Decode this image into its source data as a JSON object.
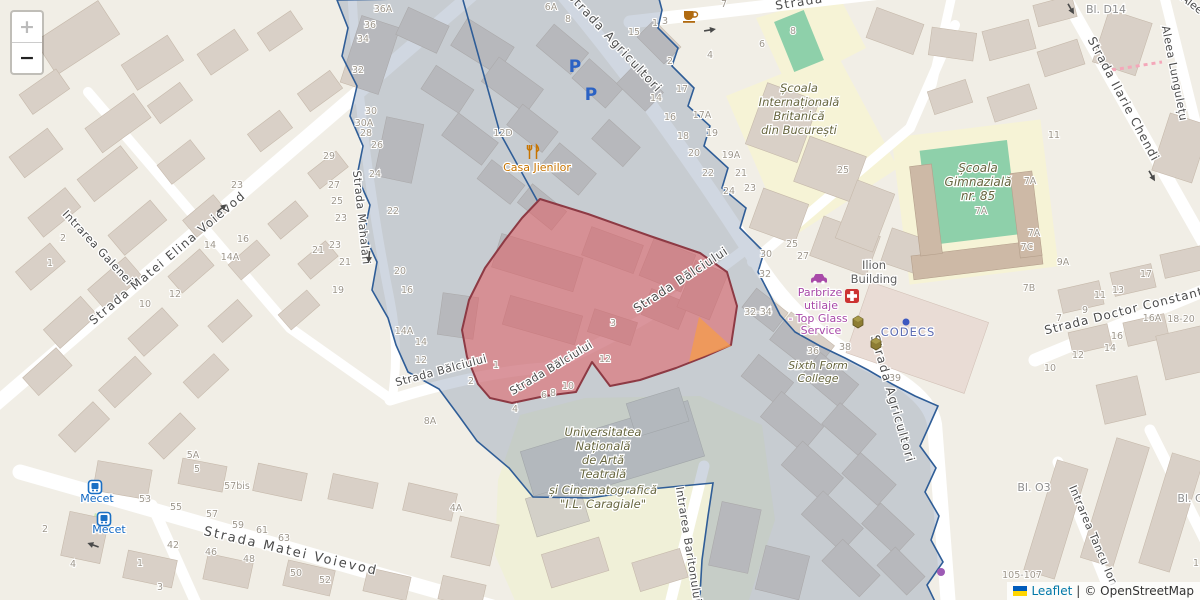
{
  "controls": {
    "zoom_in": "+",
    "zoom_out": "−"
  },
  "attribution": {
    "leaflet": "Leaflet",
    "separator": "|",
    "copyright": "© OpenStreetMap"
  },
  "colors": {
    "boundary_blue": "#2f5d97",
    "district_fill": "rgba(120,140,170,0.35)",
    "selection_red_stroke": "#8d3a44",
    "selection_red_fill": "rgba(225,95,100,0.55)",
    "highlight_orange": "rgba(244,155,78,0.8)",
    "road_white": "#ffffff",
    "building_fill": "#d9d0c7",
    "school_area": "#f6f3d6",
    "university_area": "#f0f0d8",
    "pitch_green": "#8ed0aa",
    "crossing_pink": "#f4a7b9"
  },
  "street_labels": [
    {
      "t": "Strada Agricultori",
      "x": 612,
      "y": 45,
      "rot": 47,
      "size": 12,
      "ls": 1.5
    },
    {
      "t": "Strada Agricultori",
      "x": 889,
      "y": 400,
      "rot": 74,
      "size": 12,
      "ls": 1.5
    },
    {
      "t": "Strada Bălciului",
      "x": 683,
      "y": 283,
      "rot": -33,
      "size": 12,
      "ls": 1
    },
    {
      "t": "Strada Bălciului",
      "x": 553,
      "y": 371,
      "rot": -31,
      "size": 11,
      "ls": 0.5
    },
    {
      "t": "Strada Bălciului",
      "x": 442,
      "y": 374,
      "rot": -15,
      "size": 11,
      "ls": 0.5
    },
    {
      "t": "Strada Matei Voievod",
      "x": 290,
      "y": 555,
      "rot": 13,
      "size": 13,
      "ls": 2
    },
    {
      "t": "Strada Matei Elina Voievod",
      "x": 170,
      "y": 261,
      "rot": -40,
      "size": 12,
      "ls": 1.5
    },
    {
      "t": "Intrarea Galenei",
      "x": 95,
      "y": 250,
      "rot": 47,
      "size": 11,
      "ls": 0.5
    },
    {
      "t": "Strada Mahalari",
      "x": 358,
      "y": 218,
      "rot": 84,
      "size": 11,
      "ls": 0.5
    },
    {
      "t": "Strada Ilarie Chendi",
      "x": 1120,
      "y": 101,
      "rot": 62,
      "size": 12,
      "ls": 1
    },
    {
      "t": "Aleea Lungulețu",
      "x": 1171,
      "y": 74,
      "rot": 79,
      "size": 11,
      "ls": 0.5
    },
    {
      "t": "Alee",
      "x": 1190,
      "y": 7,
      "rot": 38,
      "size": 11,
      "ls": 0
    },
    {
      "t": "Strada Doctor Constantin Zl",
      "x": 1140,
      "y": 311,
      "rot": -14,
      "size": 12,
      "ls": 1
    },
    {
      "t": "Intrarea Tancu Ion",
      "x": 1090,
      "y": 537,
      "rot": 67,
      "size": 11,
      "ls": 0.5
    },
    {
      "t": "Intrarea Baritonului",
      "x": 685,
      "y": 545,
      "rot": 81,
      "size": 11,
      "ls": 0.5
    },
    {
      "t": "Strada",
      "x": 800,
      "y": 6,
      "rot": -9,
      "size": 12,
      "ls": 1.5
    }
  ],
  "poi_labels": [
    {
      "t": "Școala",
      "x": 799,
      "y": 92,
      "cls": "school",
      "size": 11.5
    },
    {
      "t": "Internațională",
      "x": 799,
      "y": 106,
      "cls": "school",
      "size": 11.5
    },
    {
      "t": "Britanică",
      "x": 799,
      "y": 120,
      "cls": "school",
      "size": 11.5
    },
    {
      "t": "din București",
      "x": 799,
      "y": 134,
      "cls": "school",
      "size": 11.5
    },
    {
      "t": "Școala",
      "x": 978,
      "y": 172,
      "cls": "school",
      "size": 12
    },
    {
      "t": "Gimnazială",
      "x": 978,
      "y": 186,
      "cls": "school",
      "size": 12
    },
    {
      "t": "nr. 85",
      "x": 978,
      "y": 200,
      "cls": "school",
      "size": 12
    },
    {
      "t": "Sixth Form",
      "x": 818,
      "y": 369,
      "cls": "school",
      "size": 11
    },
    {
      "t": "College",
      "x": 818,
      "y": 382,
      "cls": "school",
      "size": 11
    },
    {
      "t": "Universitatea",
      "x": 603,
      "y": 436,
      "cls": "school",
      "size": 11.5
    },
    {
      "t": "Națională",
      "x": 603,
      "y": 450,
      "cls": "school",
      "size": 11.5
    },
    {
      "t": "de Artă",
      "x": 603,
      "y": 464,
      "cls": "school",
      "size": 11.5
    },
    {
      "t": "Teatrală",
      "x": 603,
      "y": 478,
      "cls": "school",
      "size": 11.5
    },
    {
      "t": "și Cinematografică",
      "x": 603,
      "y": 494,
      "cls": "school",
      "size": 11.5
    },
    {
      "t": "\"I.L. Caragiale\"",
      "x": 603,
      "y": 508,
      "cls": "school",
      "size": 11.5
    },
    {
      "t": "Casa Jienilor",
      "x": 537,
      "y": 171,
      "cls": "restaurant",
      "size": 11
    },
    {
      "t": "Ilion",
      "x": 874,
      "y": 269,
      "cls": "building-label",
      "size": 11.5
    },
    {
      "t": "Building",
      "x": 874,
      "y": 283,
      "cls": "building-label",
      "size": 11.5
    },
    {
      "t": "Parbrize",
      "x": 820,
      "y": 296,
      "cls": "shop",
      "size": 11
    },
    {
      "t": "utilaje",
      "x": 821,
      "y": 309,
      "cls": "shop",
      "size": 11
    },
    {
      "t": "- Top Glass",
      "x": 818,
      "y": 322,
      "cls": "shop",
      "size": 11
    },
    {
      "t": "Service",
      "x": 821,
      "y": 334,
      "cls": "shop",
      "size": 11
    },
    {
      "t": "CODECS",
      "x": 908,
      "y": 336,
      "cls": "office",
      "size": 11.5
    },
    {
      "t": "Mecet",
      "x": 97,
      "y": 502,
      "cls": "transit",
      "size": 11
    },
    {
      "t": "Mecet",
      "x": 109,
      "y": 533,
      "cls": "transit",
      "size": 11
    },
    {
      "t": "Bl. D14",
      "x": 1106,
      "y": 13,
      "cls": "graylabel",
      "size": 11
    },
    {
      "t": "Bl. O3",
      "x": 1034,
      "y": 491,
      "cls": "graylabel",
      "size": 11
    },
    {
      "t": "Bl. C",
      "x": 1190,
      "y": 502,
      "cls": "graylabel",
      "size": 11
    }
  ],
  "house_numbers": [
    [
      "6A",
      551,
      10
    ],
    [
      "8",
      568,
      22
    ],
    [
      "15",
      634,
      35
    ],
    [
      "1",
      655,
      26
    ],
    [
      "3",
      665,
      24
    ],
    [
      "7",
      724,
      7
    ],
    [
      "2",
      670,
      64
    ],
    [
      "4",
      710,
      58
    ],
    [
      "6",
      762,
      47
    ],
    [
      "8",
      793,
      34
    ],
    [
      "17",
      682,
      92
    ],
    [
      "14",
      656,
      101
    ],
    [
      "16",
      670,
      120
    ],
    [
      "18",
      683,
      139
    ],
    [
      "20",
      694,
      156
    ],
    [
      "17A",
      702,
      118
    ],
    [
      "19",
      712,
      136
    ],
    [
      "19A",
      731,
      158
    ],
    [
      "21",
      741,
      176
    ],
    [
      "22",
      708,
      176
    ],
    [
      "23",
      750,
      191
    ],
    [
      "24",
      729,
      194
    ],
    [
      "25",
      843,
      173
    ],
    [
      "11",
      1054,
      138
    ],
    [
      "7A",
      1030,
      184
    ],
    [
      "7A",
      981,
      214
    ],
    [
      "7A",
      1034,
      236
    ],
    [
      "7C",
      1027,
      250
    ],
    [
      "9A",
      1063,
      265
    ],
    [
      "7B",
      1029,
      291
    ],
    [
      "27",
      803,
      259
    ],
    [
      "34",
      766,
      314
    ],
    [
      "36",
      813,
      354
    ],
    [
      "38",
      845,
      350
    ],
    [
      "39",
      895,
      381
    ],
    [
      "25",
      792,
      247
    ],
    [
      "30",
      766,
      257
    ],
    [
      "32",
      765,
      277
    ],
    [
      "32-34",
      758,
      315
    ],
    [
      "14A",
      404,
      334
    ],
    [
      "14",
      421,
      345
    ],
    [
      "12",
      421,
      363
    ],
    [
      "2",
      471,
      384
    ],
    [
      "1",
      496,
      368
    ],
    [
      "4",
      515,
      412
    ],
    [
      "6",
      544,
      398
    ],
    [
      "8",
      553,
      396
    ],
    [
      "10",
      568,
      389
    ],
    [
      "12",
      605,
      362
    ],
    [
      "8A",
      430,
      424
    ],
    [
      "3",
      613,
      326
    ],
    [
      "12D",
      503,
      136
    ],
    [
      "53",
      145,
      502
    ],
    [
      "55",
      176,
      510
    ],
    [
      "57",
      212,
      517
    ],
    [
      "57bis",
      237,
      489
    ],
    [
      "59",
      238,
      528
    ],
    [
      "61",
      262,
      533
    ],
    [
      "63",
      284,
      541
    ],
    [
      "42",
      173,
      548
    ],
    [
      "46",
      211,
      555
    ],
    [
      "48",
      249,
      562
    ],
    [
      "50",
      296,
      576
    ],
    [
      "52",
      325,
      583
    ],
    [
      "4",
      73,
      567
    ],
    [
      "2",
      45,
      532
    ],
    [
      "1",
      140,
      566
    ],
    [
      "3",
      160,
      590
    ],
    [
      "23",
      237,
      188
    ],
    [
      "16",
      243,
      242
    ],
    [
      "14",
      210,
      248
    ],
    [
      "14A",
      230,
      260
    ],
    [
      "12",
      175,
      297
    ],
    [
      "10",
      145,
      307
    ],
    [
      "2",
      63,
      241
    ],
    [
      "1",
      50,
      266
    ],
    [
      "29",
      329,
      159
    ],
    [
      "27",
      334,
      188
    ],
    [
      "25",
      337,
      204
    ],
    [
      "23",
      341,
      221
    ],
    [
      "23",
      335,
      248
    ],
    [
      "21",
      318,
      253
    ],
    [
      "21",
      345,
      265
    ],
    [
      "19",
      338,
      293
    ],
    [
      "36A",
      383,
      12
    ],
    [
      "36",
      370,
      28
    ],
    [
      "34",
      363,
      42
    ],
    [
      "32",
      358,
      73
    ],
    [
      "30",
      371,
      114
    ],
    [
      "30A",
      364,
      126
    ],
    [
      "28",
      366,
      136
    ],
    [
      "26",
      377,
      148
    ],
    [
      "24",
      375,
      177
    ],
    [
      "22",
      393,
      214
    ],
    [
      "20",
      400,
      274
    ],
    [
      "16",
      407,
      293
    ],
    [
      "17",
      1146,
      277
    ],
    [
      "13",
      1118,
      293
    ],
    [
      "11",
      1100,
      298
    ],
    [
      "9",
      1085,
      313
    ],
    [
      "7",
      1059,
      321
    ],
    [
      "16A",
      1152,
      321
    ],
    [
      "18-20",
      1181,
      322
    ],
    [
      "16",
      1117,
      339
    ],
    [
      "14",
      1110,
      351
    ],
    [
      "12",
      1078,
      358
    ],
    [
      "10",
      1050,
      371
    ],
    [
      "105-107",
      1022,
      578
    ],
    [
      "1",
      1196,
      566
    ],
    [
      "5A",
      193,
      458
    ],
    [
      "5",
      197,
      472
    ],
    [
      "4A",
      456,
      511
    ]
  ],
  "icons": [
    {
      "type": "parking",
      "x": 575,
      "y": 66
    },
    {
      "type": "parking",
      "x": 591,
      "y": 94
    },
    {
      "type": "coffee",
      "x": 690,
      "y": 16
    },
    {
      "type": "restaurant",
      "x": 533,
      "y": 152
    },
    {
      "type": "hospital",
      "x": 852,
      "y": 296
    },
    {
      "type": "carshop",
      "x": 819,
      "y": 277
    },
    {
      "type": "box",
      "x": 858,
      "y": 321
    },
    {
      "type": "box",
      "x": 876,
      "y": 343
    },
    {
      "type": "dot",
      "x": 906,
      "y": 322
    },
    {
      "type": "bus",
      "x": 95,
      "y": 487
    },
    {
      "type": "bus",
      "x": 104,
      "y": 519
    },
    {
      "type": "purpledot",
      "x": 941,
      "y": 572
    },
    {
      "type": "arrow",
      "x": 710,
      "y": 30,
      "rot": -9
    },
    {
      "type": "arrow",
      "x": 222,
      "y": 208,
      "rot": -38
    },
    {
      "type": "arrow",
      "x": 1071,
      "y": 9,
      "rot": 60
    },
    {
      "type": "arrow",
      "x": 1152,
      "y": 176,
      "rot": 60
    },
    {
      "type": "arrow",
      "x": 93,
      "y": 545,
      "rot": 200
    },
    {
      "type": "arrow",
      "x": 369,
      "y": 257,
      "rot": 95
    }
  ]
}
